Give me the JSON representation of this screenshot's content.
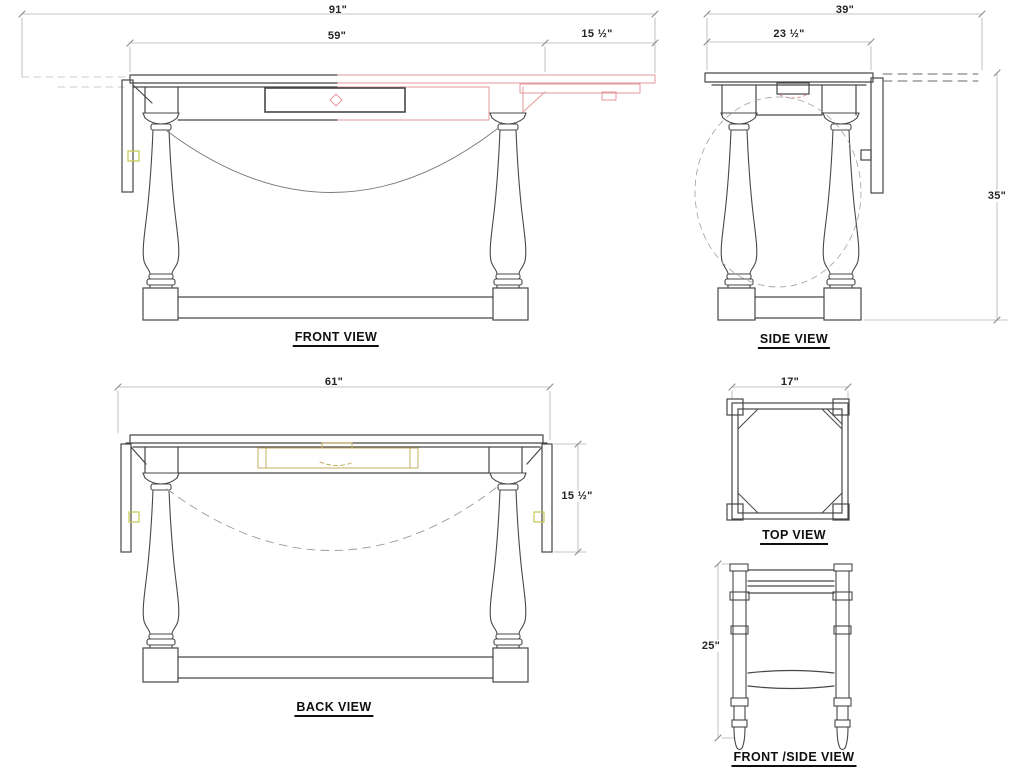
{
  "views": {
    "front": {
      "title": "FRONT VIEW",
      "dims": {
        "overall": "91\"",
        "main_top": "59\"",
        "extension": "15 ½\""
      }
    },
    "side": {
      "title": "SIDE VIEW",
      "dims": {
        "overall": "39\"",
        "main_top": "23 ½\"",
        "height": "35\""
      }
    },
    "back": {
      "title": "BACK VIEW",
      "dims": {
        "overall": "61\"",
        "leaf_drop": "15 ½\""
      }
    },
    "top": {
      "title": "TOP VIEW",
      "dims": {
        "width": "17\""
      }
    },
    "front_side": {
      "title": "FRONT /SIDE VIEW",
      "dims": {
        "height": "25\""
      }
    }
  },
  "colors": {
    "object_line": "#474747",
    "dim_line": "#b3b3b3",
    "tick": "#8a8a8a",
    "dashed_arc": "#9e9e9e",
    "extension_pink": "#e49a9a",
    "drawer_tan": "#c5ae62",
    "latch_olive": "#c6c94f"
  }
}
